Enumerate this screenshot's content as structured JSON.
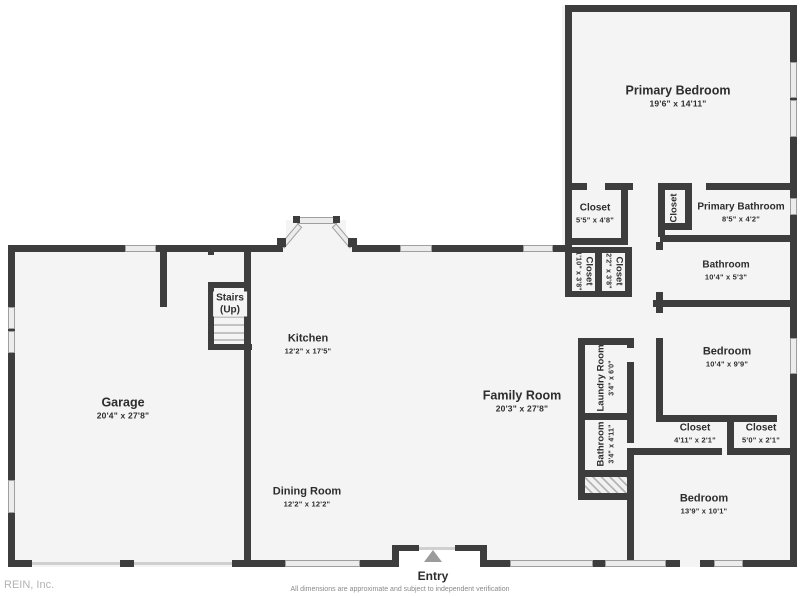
{
  "meta": {
    "watermark": "REIN, Inc.",
    "disclaimer": "All dimensions are approximate and subject to independent verification",
    "entry_label": "Entry",
    "colors": {
      "wall": "#3d3d3d",
      "floor": "#f4f4f4",
      "window": "#ececec",
      "text": "#2d2d2d",
      "arrow": "#9b9b9b"
    }
  },
  "rooms": [
    {
      "id": "primary-bedroom",
      "name": "Primary Bedroom",
      "dims": "19'6\" x 14'11\""
    },
    {
      "id": "closet-primary",
      "name": "Closet",
      "dims": "5'5\" x 4'8\""
    },
    {
      "id": "closet-hall",
      "name": "Closet",
      "dims": ""
    },
    {
      "id": "primary-bathroom",
      "name": "Primary Bathroom",
      "dims": "8'5\" x 4'2\""
    },
    {
      "id": "bathroom-hall",
      "name": "Bathroom",
      "dims": "10'4\" x 5'3\""
    },
    {
      "id": "closet-small-1",
      "name": "Closet",
      "dims": "1'10\" x 3'8\""
    },
    {
      "id": "closet-small-2",
      "name": "Closet",
      "dims": "2'2\" x 3'8\""
    },
    {
      "id": "bedroom-2",
      "name": "Bedroom",
      "dims": "10'4\" x 9'9\""
    },
    {
      "id": "laundry-room",
      "name": "Laundry Room",
      "dims": "3'4\" x 6'0\""
    },
    {
      "id": "family-room",
      "name": "Family Room",
      "dims": "20'3\" x 27'8\""
    },
    {
      "id": "bathroom-2",
      "name": "Bathroom",
      "dims": "3'4\" x 4'11\""
    },
    {
      "id": "closet-bed3-1",
      "name": "Closet",
      "dims": "4'11\" x 2'1\""
    },
    {
      "id": "closet-bed3-2",
      "name": "Closet",
      "dims": "5'0\" x 2'1\""
    },
    {
      "id": "bedroom-3",
      "name": "Bedroom",
      "dims": "13'9\" x 10'1\""
    },
    {
      "id": "kitchen",
      "name": "Kitchen",
      "dims": "12'2\" x 17'5\""
    },
    {
      "id": "garage",
      "name": "Garage",
      "dims": "20'4\" x 27'8\""
    },
    {
      "id": "dining-room",
      "name": "Dining Room",
      "dims": "12'2\" x 12'2\""
    },
    {
      "id": "stairs",
      "name": "Stairs",
      "sub": "(Up)"
    },
    {
      "id": "entry",
      "name": "Entry",
      "dims": ""
    }
  ]
}
